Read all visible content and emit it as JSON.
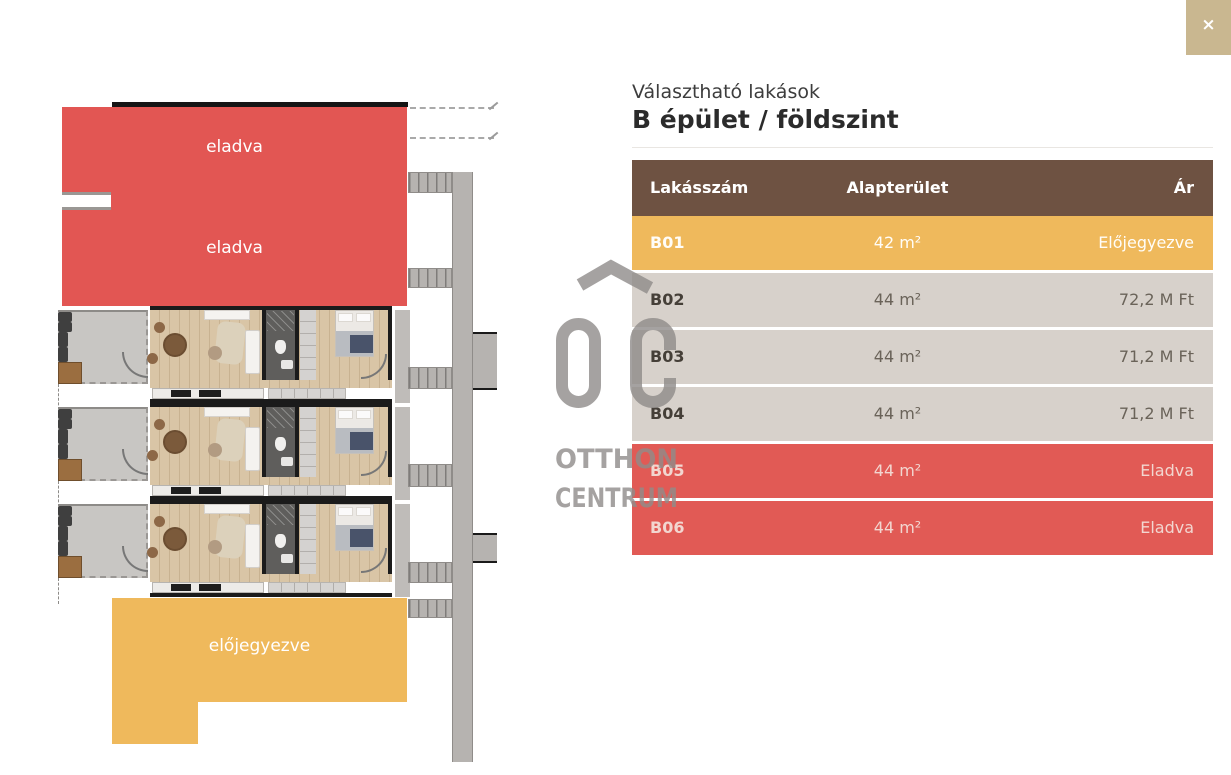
{
  "close_label": "×",
  "panel": {
    "subtitle": "Választható lakások",
    "title": "B épület / földszint"
  },
  "table": {
    "columns": [
      "Lakásszám",
      "Alapterület",
      "Ár"
    ],
    "rows": [
      {
        "id": "B01",
        "area": "42 m²",
        "price": "Előjegyezve",
        "status": "reserved"
      },
      {
        "id": "B02",
        "area": "44 m²",
        "price": "72,2 M Ft",
        "status": "available"
      },
      {
        "id": "B03",
        "area": "44 m²",
        "price": "71,2 M Ft",
        "status": "available"
      },
      {
        "id": "B04",
        "area": "44 m²",
        "price": "71,2 M Ft",
        "status": "available"
      },
      {
        "id": "B05",
        "area": "44 m²",
        "price": "Eladva",
        "status": "sold"
      },
      {
        "id": "B06",
        "area": "44 m²",
        "price": "Eladva",
        "status": "sold"
      }
    ]
  },
  "floorplan": {
    "labels": {
      "sold_upper": "eladva",
      "sold_lower": "eladva",
      "reserved": "előjegyezve"
    }
  },
  "watermark": {
    "monogram": "OC",
    "line1": "OTTHON",
    "line2": "CENTRUM"
  },
  "colors": {
    "sold": "#e25653",
    "sold_row": "#e15a55",
    "reserved": "#efb95c",
    "header": "#6e5242",
    "row": "#d7d1cb",
    "close": "#c9b790",
    "watermark": "#8f8c8a"
  }
}
